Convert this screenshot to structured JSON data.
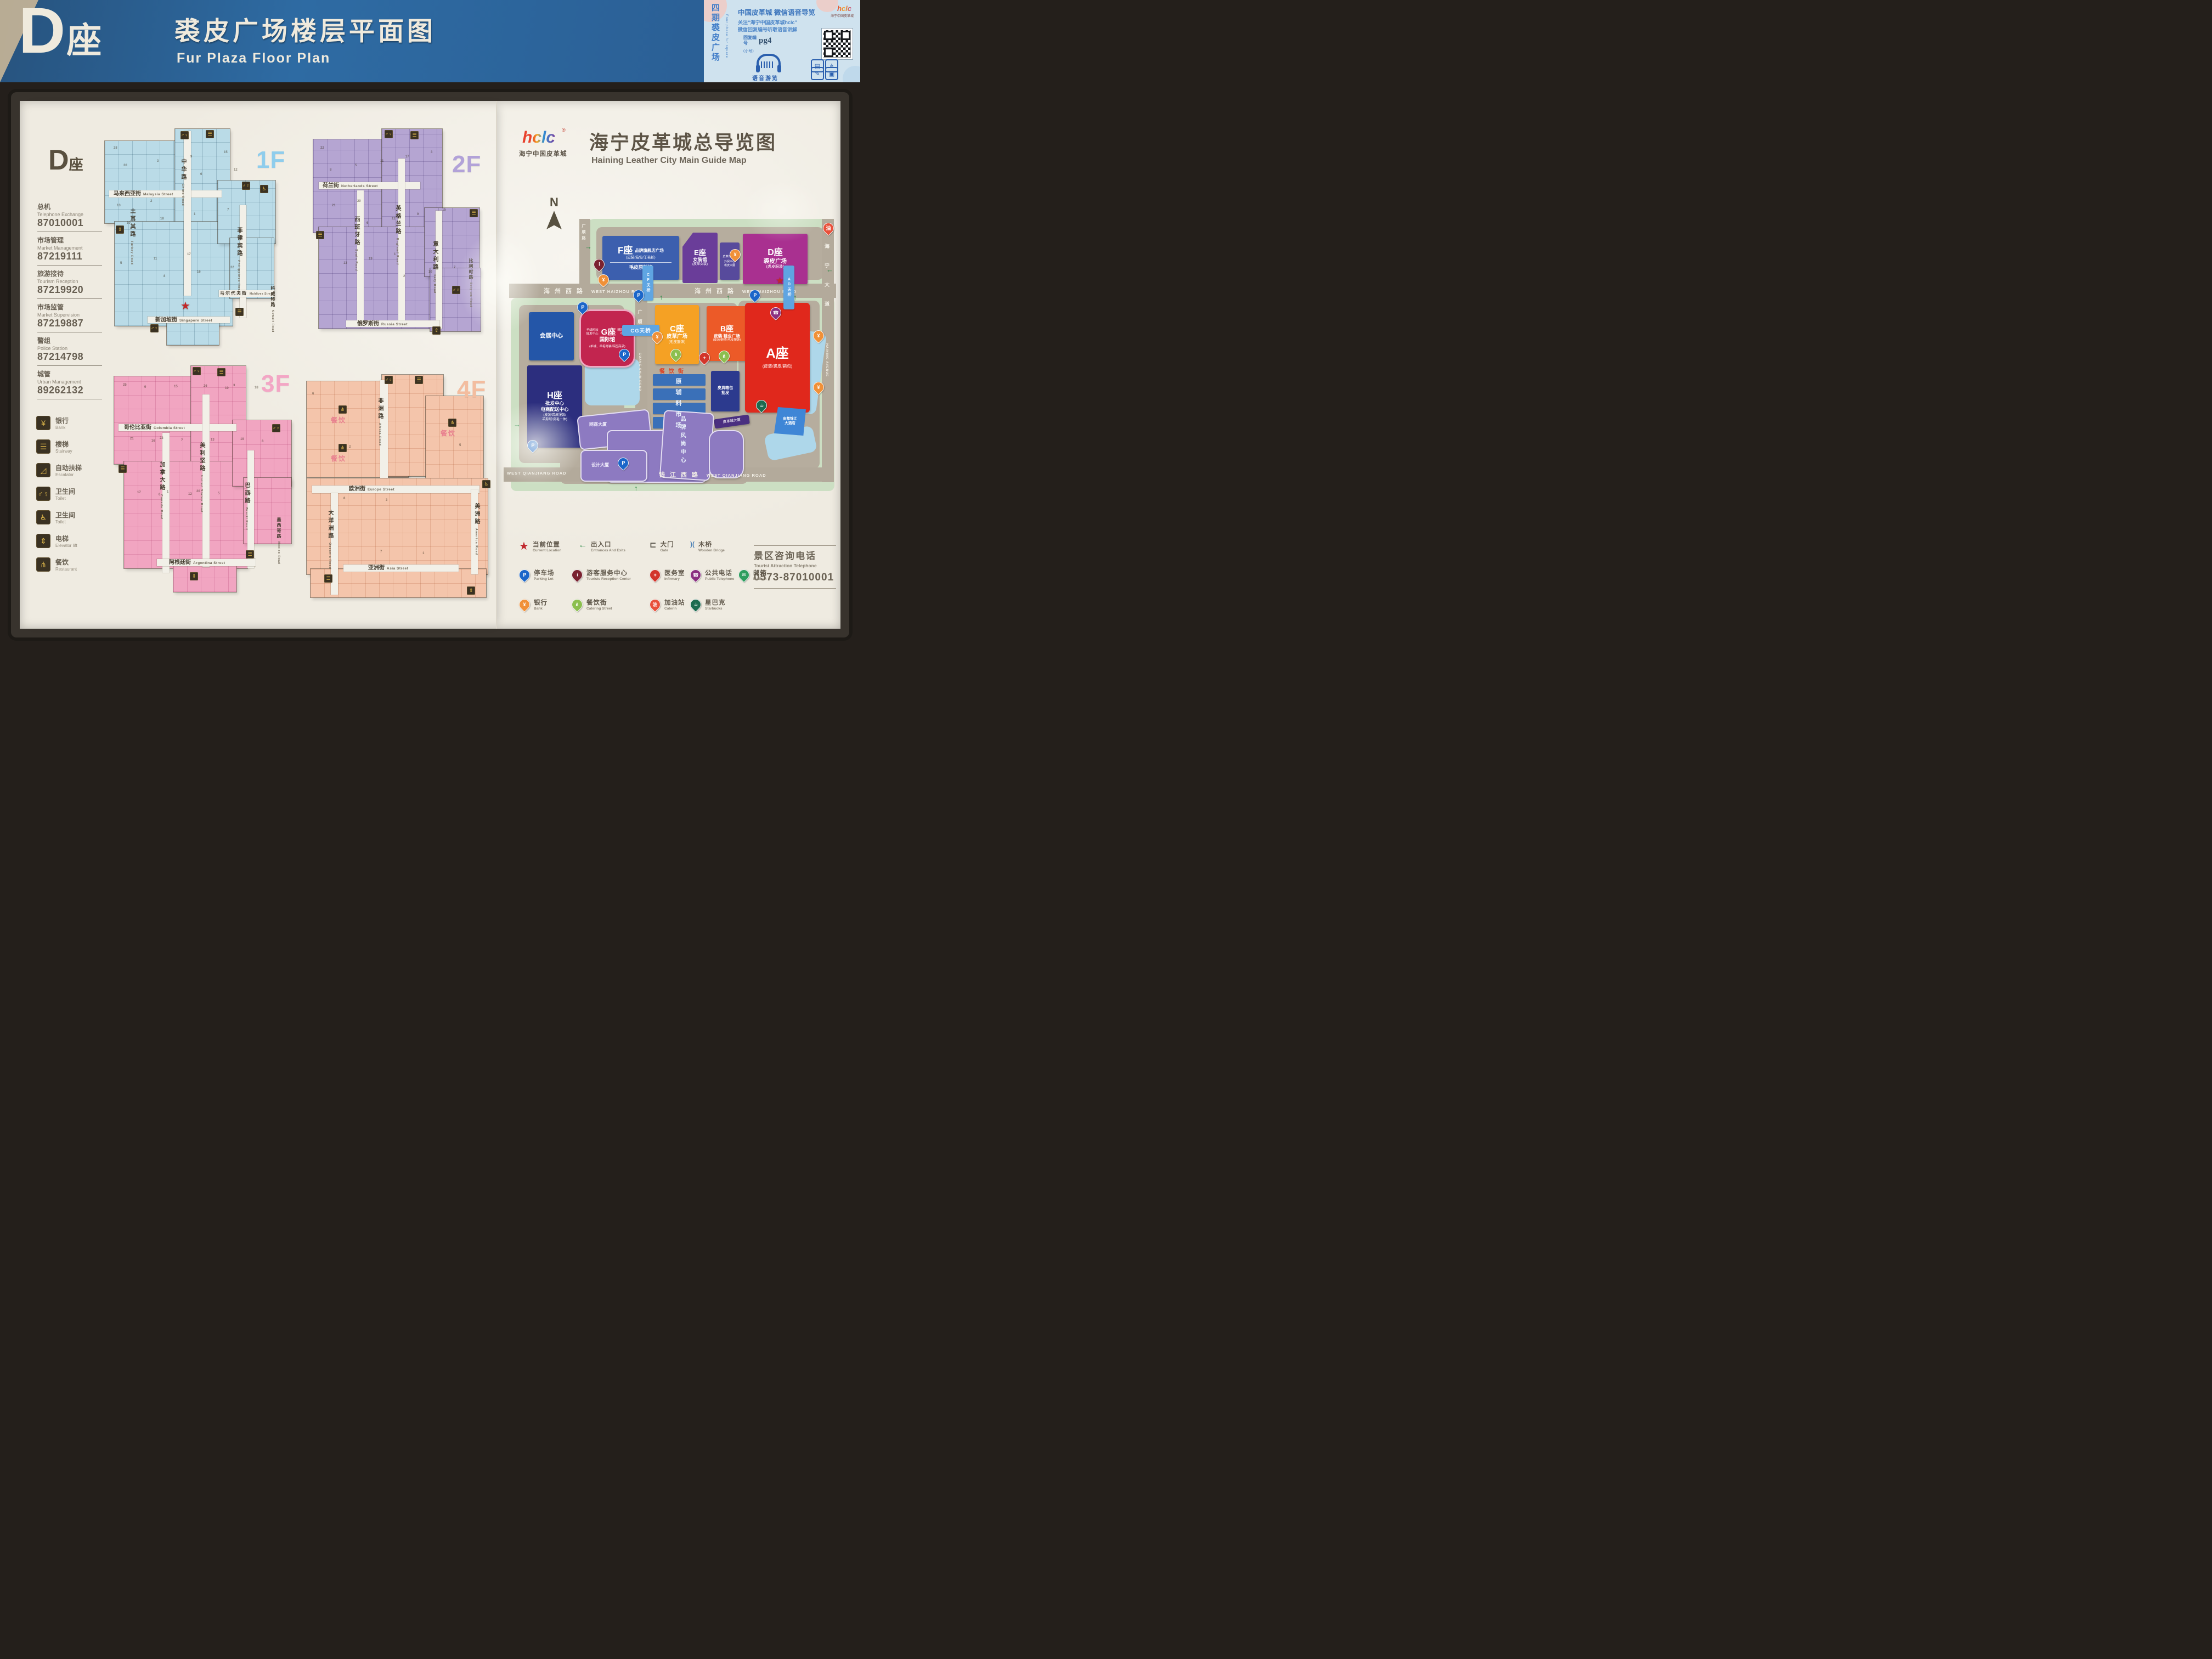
{
  "header": {
    "building_letter": "D",
    "building_suffix": "座",
    "title_zh": "裘皮广场楼层平面图",
    "title_en": "Fur Plaza  Floor Plan",
    "info_card": {
      "vertical_zh": "四期裘皮广场",
      "vertical_en": "Four phase fur square",
      "logo": "hclc",
      "reg": "®",
      "logo_sub": "海宁中国皮革城",
      "headline": "中国皮革城 微信语音导览",
      "line1": "关注“海宁中国皮革城hclc”",
      "line2": "微信回复编号听取语音讲解",
      "reply_label": "回复编号",
      "reply_code": "pg4",
      "reply_note": "(小号)",
      "audio_caption": "语音游览"
    }
  },
  "left_panel": {
    "building_letter": "D",
    "building_suffix": "座",
    "contacts": [
      {
        "zh": "总机",
        "en": "Telephone Exchange",
        "tel": "87010001"
      },
      {
        "zh": "市场管理",
        "en": "Market Management",
        "tel": "87219111"
      },
      {
        "zh": "旅游接待",
        "en": "Tourism Reception",
        "tel": "87219920"
      },
      {
        "zh": "市场监管",
        "en": "Market Supervision",
        "tel": "87219887"
      },
      {
        "zh": "警组",
        "en": "Police Station",
        "tel": "87214798"
      },
      {
        "zh": "城管",
        "en": "Urban Management",
        "tel": "89262132"
      }
    ],
    "amenity_legend": [
      {
        "zh": "银行",
        "en": "Bank",
        "icon": "bank"
      },
      {
        "zh": "楼梯",
        "en": "Stairway",
        "icon": "stairway"
      },
      {
        "zh": "自动扶梯",
        "en": "Escalator",
        "icon": "escalator"
      },
      {
        "zh": "卫生间",
        "en": "Toilet",
        "icon": "toilet"
      },
      {
        "zh": "卫生间",
        "en": "Toilet",
        "icon": "accessible_toilet"
      },
      {
        "zh": "电梯",
        "en": "Elevator lift",
        "icon": "elevator"
      },
      {
        "zh": "餐饮",
        "en": "Restaurant",
        "icon": "restaurant"
      }
    ],
    "floors": [
      {
        "label": "1F",
        "streets": [
          {
            "zh": "马来西亚街",
            "en": "Malaysia Street"
          },
          {
            "zh": "中华路",
            "en": "China Road"
          },
          {
            "zh": "土耳其路",
            "en": "Turkey Road"
          },
          {
            "zh": "菲律宾路",
            "en": "Philippines Road"
          },
          {
            "zh": "马尔代夫街",
            "en": "Maldives Street"
          },
          {
            "zh": "科威特路",
            "en": "Kuwait Road"
          },
          {
            "zh": "新加坡街",
            "en": "Singapore Street"
          }
        ],
        "units": [
          "28",
          "2",
          "17",
          "15",
          "13",
          "11",
          "9",
          "7",
          "5",
          "3",
          "1",
          "22",
          "20",
          "18",
          "16",
          "12",
          "10",
          "8",
          "6"
        ]
      },
      {
        "label": "2F",
        "streets": [
          {
            "zh": "荷兰街",
            "en": "Netherlands Street"
          },
          {
            "zh": "西班牙路",
            "en": "Spain Road"
          },
          {
            "zh": "英格兰路",
            "en": "England Road"
          },
          {
            "zh": "意大利路",
            "en": "Italy Road"
          },
          {
            "zh": "比利时路",
            "en": "Belgium Road"
          },
          {
            "zh": "俄罗斯街",
            "en": "Russia Street"
          }
        ],
        "units": [
          "22",
          "20",
          "1",
          "3",
          "21",
          "19",
          "17",
          "15",
          "13",
          "11",
          "9",
          "7",
          "5",
          "12",
          "10",
          "8",
          "6",
          "2"
        ]
      },
      {
        "label": "3F",
        "streets": [
          {
            "zh": "哥伦比亚街",
            "en": "Columbia Street"
          },
          {
            "zh": "加拿大路",
            "en": "Canada Road"
          },
          {
            "zh": "美利坚路",
            "en": "United States Road"
          },
          {
            "zh": "巴西路",
            "en": "Brazil Road"
          },
          {
            "zh": "墨西哥路",
            "en": "Mexico Road"
          },
          {
            "zh": "阿根廷街",
            "en": "Argentina Street"
          }
        ],
        "units": [
          "25",
          "22",
          "20",
          "3",
          "21",
          "1",
          "26",
          "19",
          "17",
          "15",
          "13",
          "11",
          "9",
          "7",
          "5",
          "18",
          "16",
          "12",
          "10",
          "8",
          "6"
        ]
      },
      {
        "label": "4F",
        "streets": [
          {
            "zh": "非洲路",
            "en": "Africa Road"
          },
          {
            "zh": "欧洲街",
            "en": "Europe Street"
          },
          {
            "zh": "大洋洲路",
            "en": "Oceania Road"
          },
          {
            "zh": "美洲路",
            "en": "America Road"
          },
          {
            "zh": "亚洲街",
            "en": "Asia Street"
          }
        ],
        "restaurants": [
          "餐饮",
          "餐饮",
          "餐饮"
        ],
        "units": [
          "6",
          "2",
          "3",
          "1",
          "5",
          "8",
          "7"
        ]
      }
    ]
  },
  "right_panel": {
    "logo": "hclc",
    "reg": "®",
    "logo_sub": "海宁中国皮革城",
    "title_zh": "海宁皮革城总导览图",
    "title_en": "Haining Leather City Main Guide Map",
    "compass": "N",
    "map": {
      "buildings": {
        "f": {
          "title": "F座",
          "line1": "品牌旗舰店广场",
          "line2": "(皮装/箱包/羊毛衫)",
          "line3": "毛皮原料馆"
        },
        "e": {
          "title": "E座",
          "line1": "女装馆",
          "line2": "(皮革女装)"
        },
        "museum": {
          "line1": "皮革博物馆",
          "line2": "外贸中心",
          "line3": "裘皮大厦"
        },
        "d": {
          "title": "D座",
          "line1": "裘皮广场",
          "line2": "(裘皮服装)"
        },
        "exhibition": {
          "line1": "会展中心"
        },
        "g": {
          "title": "G座",
          "name": "国际馆",
          "left": "羊绒时装批发中心",
          "right": "韩国时尚中心",
          "sub": "(羊绒、羊毛时装/韩国商品)"
        },
        "h": {
          "title": "H座",
          "line1": "批发中心",
          "line2": "电商配送中心",
          "line3": "(皮装/裘皮服装/",
          "line4": "羊剪绒/皮毛一体)"
        },
        "c": {
          "title": "C座",
          "line1": "皮草广场",
          "line2": "(毛皮服饰)"
        },
        "b": {
          "title": "B座",
          "line1": "皮装·鞋业广场",
          "line2": "(皮装/鞋类/毛皮服饰)"
        },
        "a": {
          "title": "A座",
          "line1": "(皮装/裘皮/箱包)"
        },
        "raw_market": {
          "vertical": "原辅料市场"
        },
        "luggage": {
          "line1": "皮具箱包",
          "line2": "批发"
        },
        "tower": {
          "line1": "皮革城大厦"
        },
        "ecommerce": {
          "line1": "网商大厦"
        },
        "design": {
          "line1": "设计大厦"
        },
        "fashion": {
          "vertical": "品牌风尚中心"
        },
        "hotel": {
          "line1": "皮都锦江",
          "line2": "大酒店"
        }
      },
      "roads": {
        "haizhou_zh": "海州西路",
        "haizhou_en": "WEST HAIZHOU ROAD",
        "qianjiang_zh": "钱江西路",
        "qianjiang_en": "WEST QIANJIANG ROAD",
        "haining_zh": "海宁大道",
        "haining_en": "HAINING AVENUE",
        "guangshun_zh": "广顺路",
        "guangshun_en": "GUANG SHUN ROAD"
      },
      "bridges": {
        "cf": "CF天桥",
        "ad": "AD天桥",
        "cg": "CG天桥"
      },
      "food_street": "餐饮街"
    },
    "legend_rows": [
      [
        {
          "icon": "current_star",
          "zh": "当前位置",
          "en": "Current Location"
        },
        {
          "icon": "entrance_arrow",
          "zh": "出入口",
          "en": "Entrances And Exits"
        },
        {
          "icon": "gate",
          "zh": "大门",
          "en": "Gate"
        },
        {
          "icon": "wooden_bridge",
          "zh": "木桥",
          "en": "Wooden Bridge"
        }
      ],
      [
        {
          "icon": "parking",
          "zh": "停车场",
          "en": "Parking Lot"
        },
        {
          "icon": "reception",
          "zh": "游客服务中心",
          "en": "Tourists Reception Center"
        },
        {
          "icon": "infirmary",
          "zh": "医务室",
          "en": "Infirmary"
        },
        {
          "icon": "telephone",
          "zh": "公共电话",
          "en": "Public Telephone"
        },
        {
          "icon": "mailbox",
          "zh": "邮箱",
          "en": "Mailbox"
        }
      ],
      [
        {
          "icon": "bank",
          "zh": "银行",
          "en": "Bank"
        },
        {
          "icon": "catering",
          "zh": "餐饮街",
          "en": "Catering Street"
        },
        {
          "icon": "gas",
          "zh": "加油站",
          "en": "Caterin"
        },
        {
          "icon": "starbucks",
          "zh": "星巴克",
          "en": "Starbucks"
        }
      ]
    ],
    "hotline": {
      "zh": "景区咨询电话",
      "en": "Tourist Attraction Telephone",
      "tel": "0573-87010001"
    }
  },
  "icons": {
    "parking": "P",
    "bank": "¥",
    "info": "i",
    "telephone": "☎",
    "medical": "+",
    "mailbox": "✉",
    "food": "⋔",
    "gas": "油",
    "starbucks": "☕",
    "star": "★",
    "arrow_left": "←",
    "arrow_up": "↑",
    "arrow_right": "→",
    "gate": "⊏",
    "wooden_bridge": ")(",
    "stairway": "☰",
    "escalator": "◿",
    "toilet": "♂♀",
    "accessible_toilet": "♿",
    "elevator": "⇕",
    "restaurant": "⋔"
  }
}
